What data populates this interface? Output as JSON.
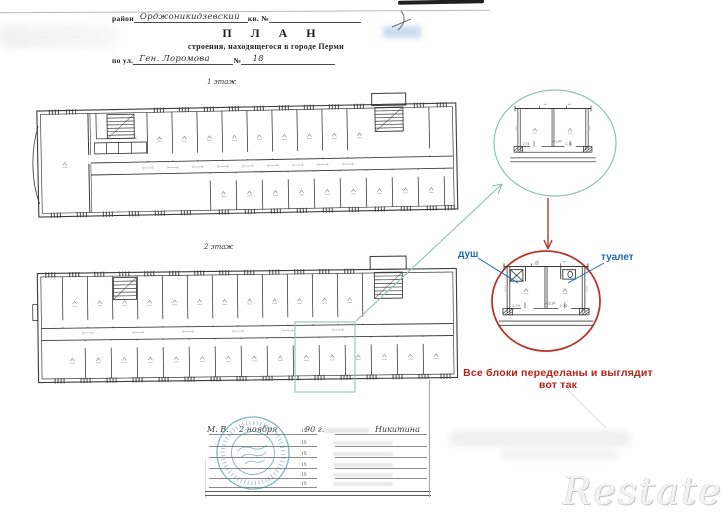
{
  "header": {
    "district_label": "район",
    "district_value": "Орджоникидзевский",
    "kv_label": "кв. №",
    "title": "П Л А Н",
    "subtitle": "строения, находящегося в городе Перми",
    "street_label": "по ул.",
    "street_value": "Ген. Лоромова",
    "number_label": "№",
    "house_number": "18"
  },
  "plans": [
    {
      "label": "1 этаж"
    },
    {
      "label": "2 этаж"
    }
  ],
  "annotations": {
    "shower_label": "душ",
    "toilet_label": "туалет",
    "note": "Все блоки переделаны и выглядит вот так",
    "colors": {
      "green": "#8fc3a8",
      "red": "#b5382c",
      "red_text": "#b02318",
      "blue": "#1e6cb0",
      "stamp": "#43909e",
      "ink": "#3c3c3c"
    }
  },
  "detail": {
    "height_mark": "Н-2,97",
    "dim_left": "2,74",
    "dim_right": "2,74",
    "room_no": "92"
  },
  "footer": {
    "row1_pre": "М. В.",
    "row1_date": "2 ноября",
    "year_printed": "19",
    "row1_year": "90 г.",
    "row1_name": "Никитина"
  },
  "watermark": {
    "text": "Restate"
  }
}
